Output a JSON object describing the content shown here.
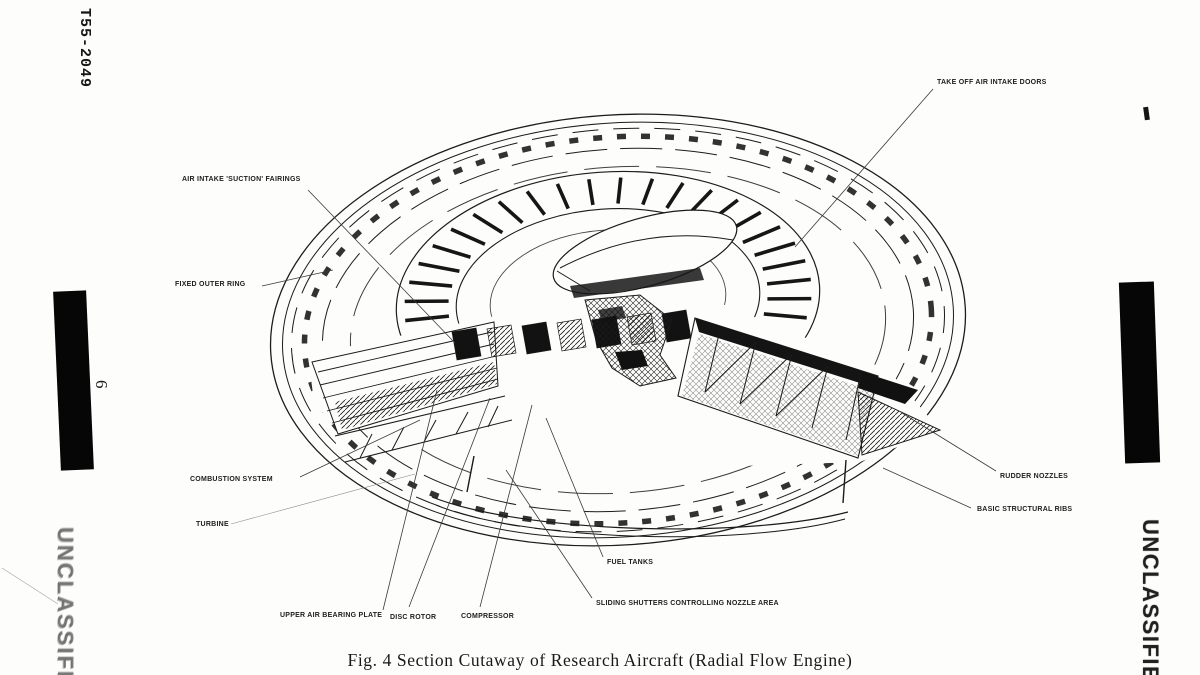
{
  "page": {
    "doc_number": "T55-2049",
    "page_number": "6",
    "left_stamp": "UNCLASSIFIED",
    "right_stamp": "UNCLASSIFIED",
    "caption": "Fig. 4  Section Cutaway of Research Aircraft (Radial Flow Engine)"
  },
  "figure": {
    "labels": {
      "take_off_doors": "TAKE OFF AIR INTAKE DOORS",
      "air_intake_fairings": "AIR INTAKE 'SUCTION' FAIRINGS",
      "fixed_outer_ring": "FIXED OUTER RING",
      "combustion_system": "COMBUSTION SYSTEM",
      "turbine": "TURBINE",
      "upper_air_bearing_plate": "UPPER AIR BEARING PLATE",
      "disc_rotor": "DISC ROTOR",
      "compressor": "COMPRESSOR",
      "fuel_tanks": "FUEL TANKS",
      "sliding_shutters": "SLIDING SHUTTERS CONTROLLING NOZZLE AREA",
      "rudder_nozzles": "RUDDER NOZZLES",
      "basic_structural_ribs": "BASIC STRUCTURAL RIBS"
    }
  }
}
